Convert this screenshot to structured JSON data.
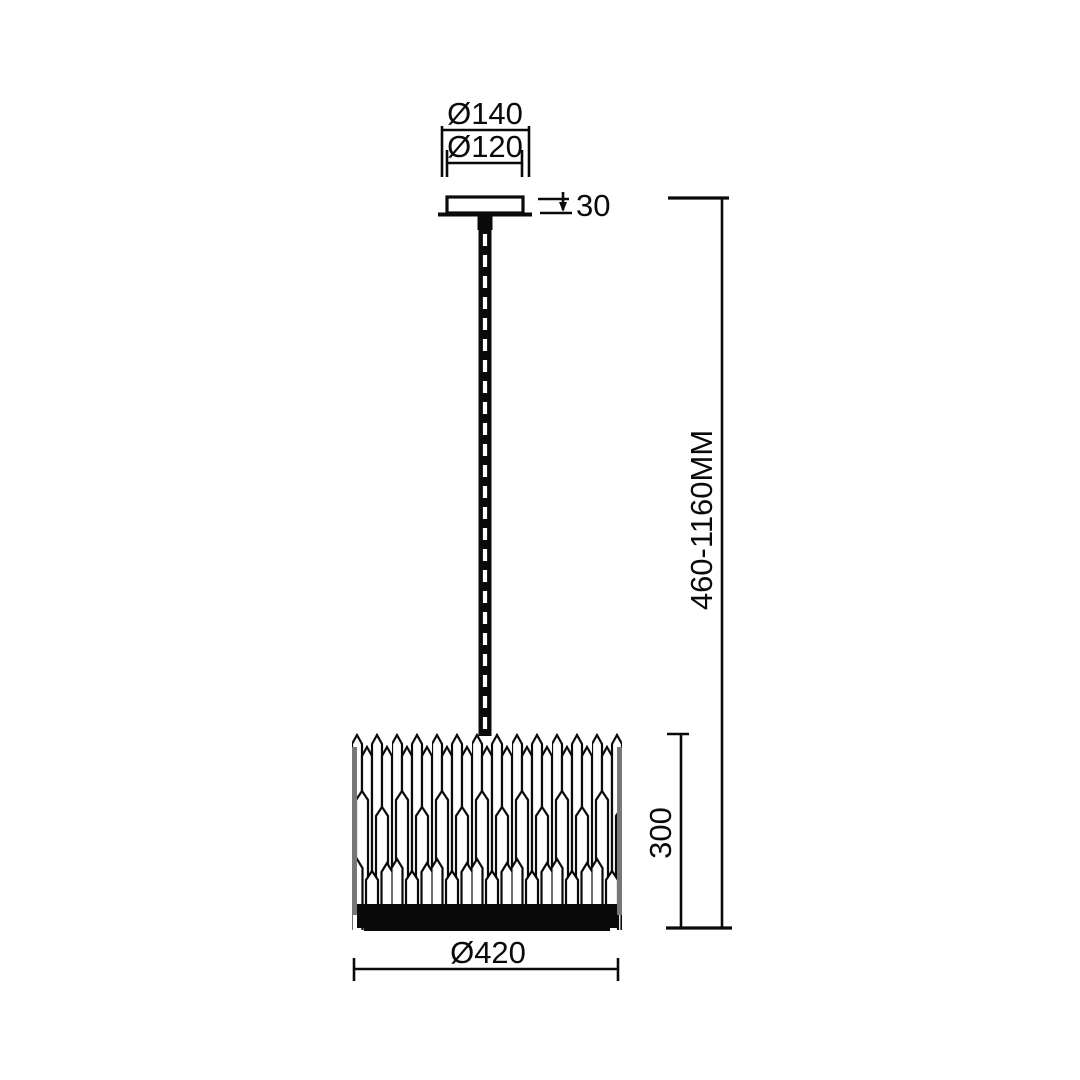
{
  "drawing": {
    "type": "pendant-lamp-dimension-drawing",
    "background_color": "#ffffff",
    "line_color": "#0a0a0a"
  },
  "dimensions": {
    "canopy_outer_diameter": "Ø140",
    "canopy_inner_diameter": "Ø120",
    "canopy_height": "30",
    "suspension_height_range": "460-1160MM",
    "shade_height": "300",
    "shade_diameter": "Ø420"
  }
}
